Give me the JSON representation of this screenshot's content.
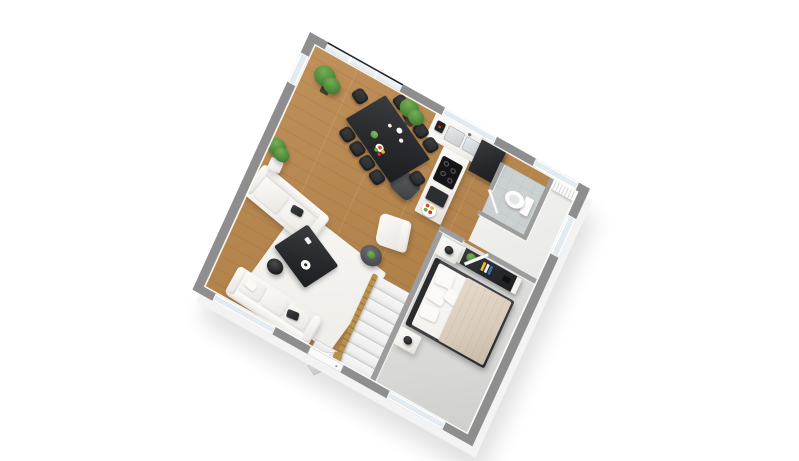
{
  "scene": {
    "description": "3D isometric floor plan rendering of a one-bedroom apartment, viewed from above at a rotated angle on a white background",
    "background": "#ffffff"
  },
  "palette": {
    "wall_top": "#8e8e8e",
    "wall_skirt": "#f3f3f3",
    "interior_wall": "#9d9d9d",
    "wood_floor": "#b2824b",
    "wood_floor_light": "#c0905a",
    "carpet": "#d9d9d7",
    "bath_tile": "#cbd0d0",
    "hall_tile": "#e9e9e7",
    "glass": "#e3ebf0",
    "glass_rail": "#23262a",
    "white_furniture": "#f2f0ec",
    "black_furniture": "#27292c",
    "dark_gray": "#4b4d50",
    "stair_tread": "#efefef",
    "railing_wood": "#b8914f",
    "bed_blanket": "#d9cbbb",
    "plant_green": "#4f8a3b",
    "steel": "#c9ced2"
  },
  "rooms": [
    {
      "name": "living-dining-room",
      "floor": "wood"
    },
    {
      "name": "kitchen",
      "floor": "wood"
    },
    {
      "name": "wc",
      "floor": "tile"
    },
    {
      "name": "hallway",
      "floor": "tile"
    },
    {
      "name": "bedroom",
      "floor": "carpet"
    },
    {
      "name": "staircase",
      "floor": "stairs"
    }
  ],
  "furniture": {
    "dining_chairs": 10,
    "dining_tables": 1,
    "seating": [
      "three-seat-sofa",
      "two-seat-loveseat",
      "armchair",
      "kitchen-chair"
    ],
    "plants": 5,
    "beds": 1,
    "nightstands": 2,
    "toilets": 1,
    "radiators": 1,
    "fridges": 1,
    "cooktop_burners": 4
  },
  "stairs": {
    "main_treads": 8,
    "winder_treads": 3
  },
  "decor": {
    "book_colors": [
      "#e4bd3a",
      "#f1efe9",
      "#3c6db0"
    ],
    "fruit_colors": [
      "#d64b2f",
      "#e9b832",
      "#63a93c",
      "#c9372a"
    ]
  }
}
